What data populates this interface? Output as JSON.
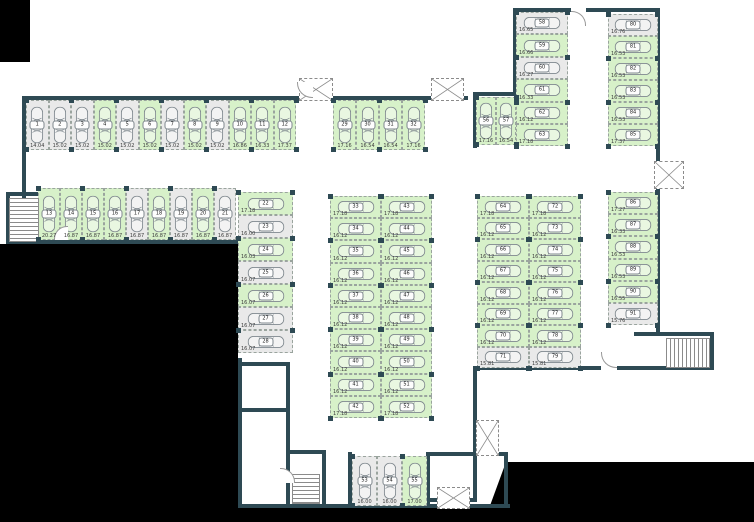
{
  "plan": {
    "name": "underground-parking-floor-plan",
    "colors": {
      "wall": "#2e4a54",
      "space_marked": "#d7f1c9",
      "space_unmarked": "#e9e9e9",
      "void": "#000000",
      "dash": "#9aa49e"
    },
    "groups": [
      {
        "id": "row-1-12",
        "spaces": [
          {
            "n": "1",
            "area": "14.04",
            "marked": false
          },
          {
            "n": "2",
            "area": "15.02",
            "marked": false
          },
          {
            "n": "3",
            "area": "15.02",
            "marked": false
          },
          {
            "n": "4",
            "area": "15.02",
            "marked": true
          },
          {
            "n": "5",
            "area": "15.02",
            "marked": false
          },
          {
            "n": "6",
            "area": "15.02",
            "marked": true
          },
          {
            "n": "7",
            "area": "15.02",
            "marked": false
          },
          {
            "n": "8",
            "area": "15.02",
            "marked": true
          },
          {
            "n": "9",
            "area": "15.02",
            "marked": false
          },
          {
            "n": "10",
            "area": "16.86",
            "marked": true
          },
          {
            "n": "11",
            "area": "16.33",
            "marked": true
          },
          {
            "n": "12",
            "area": "17.37",
            "marked": true
          }
        ]
      },
      {
        "id": "row-13-21",
        "spaces": [
          {
            "n": "13",
            "area": "20.27",
            "marked": true
          },
          {
            "n": "14",
            "area": "16.87",
            "marked": true
          },
          {
            "n": "15",
            "area": "16.87",
            "marked": true
          },
          {
            "n": "16",
            "area": "16.87",
            "marked": true
          },
          {
            "n": "17",
            "area": "16.87",
            "marked": false
          },
          {
            "n": "18",
            "area": "16.87",
            "marked": true
          },
          {
            "n": "19",
            "area": "16.87",
            "marked": false
          },
          {
            "n": "20",
            "area": "16.87",
            "marked": true
          },
          {
            "n": "21",
            "area": "16.87",
            "marked": false
          }
        ]
      },
      {
        "id": "col-22-28",
        "spaces": [
          {
            "n": "22",
            "area": "17.18",
            "marked": true
          },
          {
            "n": "23",
            "area": "16.00",
            "marked": false
          },
          {
            "n": "24",
            "area": "16.03",
            "marked": true
          },
          {
            "n": "25",
            "area": "16.07",
            "marked": false
          },
          {
            "n": "26",
            "area": "16.07",
            "marked": true
          },
          {
            "n": "27",
            "area": "16.07",
            "marked": false
          },
          {
            "n": "28",
            "area": "16.07",
            "marked": false
          }
        ]
      },
      {
        "id": "row-29-32",
        "spaces": [
          {
            "n": "29",
            "area": "17.16",
            "marked": true
          },
          {
            "n": "30",
            "area": "16.54",
            "marked": true
          },
          {
            "n": "31",
            "area": "16.54",
            "marked": true
          },
          {
            "n": "32",
            "area": "17.16",
            "marked": true
          }
        ]
      },
      {
        "id": "col-33-42",
        "spaces": [
          {
            "n": "33",
            "area": "17.18",
            "marked": true
          },
          {
            "n": "34",
            "area": "16.12",
            "marked": true
          },
          {
            "n": "35",
            "area": "16.12",
            "marked": true
          },
          {
            "n": "36",
            "area": "16.12",
            "marked": true
          },
          {
            "n": "37",
            "area": "16.12",
            "marked": true
          },
          {
            "n": "38",
            "area": "16.12",
            "marked": true
          },
          {
            "n": "39",
            "area": "16.12",
            "marked": true
          },
          {
            "n": "40",
            "area": "16.12",
            "marked": true
          },
          {
            "n": "41",
            "area": "16.12",
            "marked": true
          },
          {
            "n": "42",
            "area": "17.18",
            "marked": true
          }
        ]
      },
      {
        "id": "col-43-52",
        "spaces": [
          {
            "n": "43",
            "area": "17.18",
            "marked": true
          },
          {
            "n": "44",
            "area": "16.12",
            "marked": true
          },
          {
            "n": "45",
            "area": "16.12",
            "marked": true
          },
          {
            "n": "46",
            "area": "16.12",
            "marked": true
          },
          {
            "n": "47",
            "area": "16.12",
            "marked": true
          },
          {
            "n": "48",
            "area": "16.12",
            "marked": true
          },
          {
            "n": "49",
            "area": "16.12",
            "marked": true
          },
          {
            "n": "50",
            "area": "16.12",
            "marked": true
          },
          {
            "n": "51",
            "area": "16.12",
            "marked": true
          },
          {
            "n": "52",
            "area": "17.18",
            "marked": true
          }
        ]
      },
      {
        "id": "row-53-55",
        "spaces": [
          {
            "n": "53",
            "area": "16.00",
            "marked": false
          },
          {
            "n": "54",
            "area": "16.00",
            "marked": false
          },
          {
            "n": "55",
            "area": "17.00",
            "marked": true
          }
        ]
      },
      {
        "id": "row-56-57",
        "spaces": [
          {
            "n": "56",
            "area": "17.16",
            "marked": true
          },
          {
            "n": "57",
            "area": "16.54",
            "marked": true
          }
        ]
      },
      {
        "id": "col-58-63",
        "spaces": [
          {
            "n": "58",
            "area": "16.65",
            "marked": false
          },
          {
            "n": "59",
            "area": "16.66",
            "marked": true
          },
          {
            "n": "60",
            "area": "16.27",
            "marked": false
          },
          {
            "n": "61",
            "area": "16.33",
            "marked": true
          },
          {
            "n": "62",
            "area": "16.12",
            "marked": true
          },
          {
            "n": "63",
            "area": "17.18",
            "marked": true
          }
        ]
      },
      {
        "id": "col-64-71",
        "spaces": [
          {
            "n": "64",
            "area": "17.18",
            "marked": true
          },
          {
            "n": "65",
            "area": "16.12",
            "marked": true
          },
          {
            "n": "66",
            "area": "16.12",
            "marked": true
          },
          {
            "n": "67",
            "area": "16.12",
            "marked": true
          },
          {
            "n": "68",
            "area": "16.12",
            "marked": true
          },
          {
            "n": "69",
            "area": "16.12",
            "marked": true
          },
          {
            "n": "70",
            "area": "16.12",
            "marked": true
          },
          {
            "n": "71",
            "area": "15.81",
            "marked": false
          }
        ]
      },
      {
        "id": "col-72-79",
        "spaces": [
          {
            "n": "72",
            "area": "17.18",
            "marked": true
          },
          {
            "n": "73",
            "area": "16.12",
            "marked": true
          },
          {
            "n": "74",
            "area": "16.12",
            "marked": true
          },
          {
            "n": "75",
            "area": "16.12",
            "marked": true
          },
          {
            "n": "76",
            "area": "16.12",
            "marked": true
          },
          {
            "n": "77",
            "area": "16.12",
            "marked": true
          },
          {
            "n": "78",
            "area": "16.12",
            "marked": true
          },
          {
            "n": "79",
            "area": "15.81",
            "marked": false
          }
        ]
      },
      {
        "id": "col-80-85",
        "spaces": [
          {
            "n": "80",
            "area": "16.76",
            "marked": false
          },
          {
            "n": "81",
            "area": "16.53",
            "marked": true
          },
          {
            "n": "82",
            "area": "16.53",
            "marked": true
          },
          {
            "n": "83",
            "area": "16.53",
            "marked": true
          },
          {
            "n": "84",
            "area": "16.53",
            "marked": true
          },
          {
            "n": "85",
            "area": "17.37",
            "marked": true
          }
        ]
      },
      {
        "id": "col-86-91",
        "spaces": [
          {
            "n": "86",
            "area": "17.27",
            "marked": true
          },
          {
            "n": "87",
            "area": "16.33",
            "marked": true
          },
          {
            "n": "88",
            "area": "16.53",
            "marked": true
          },
          {
            "n": "89",
            "area": "16.53",
            "marked": true
          },
          {
            "n": "90",
            "area": "16.55",
            "marked": true
          },
          {
            "n": "91",
            "area": "15.76",
            "marked": false
          }
        ]
      }
    ]
  }
}
